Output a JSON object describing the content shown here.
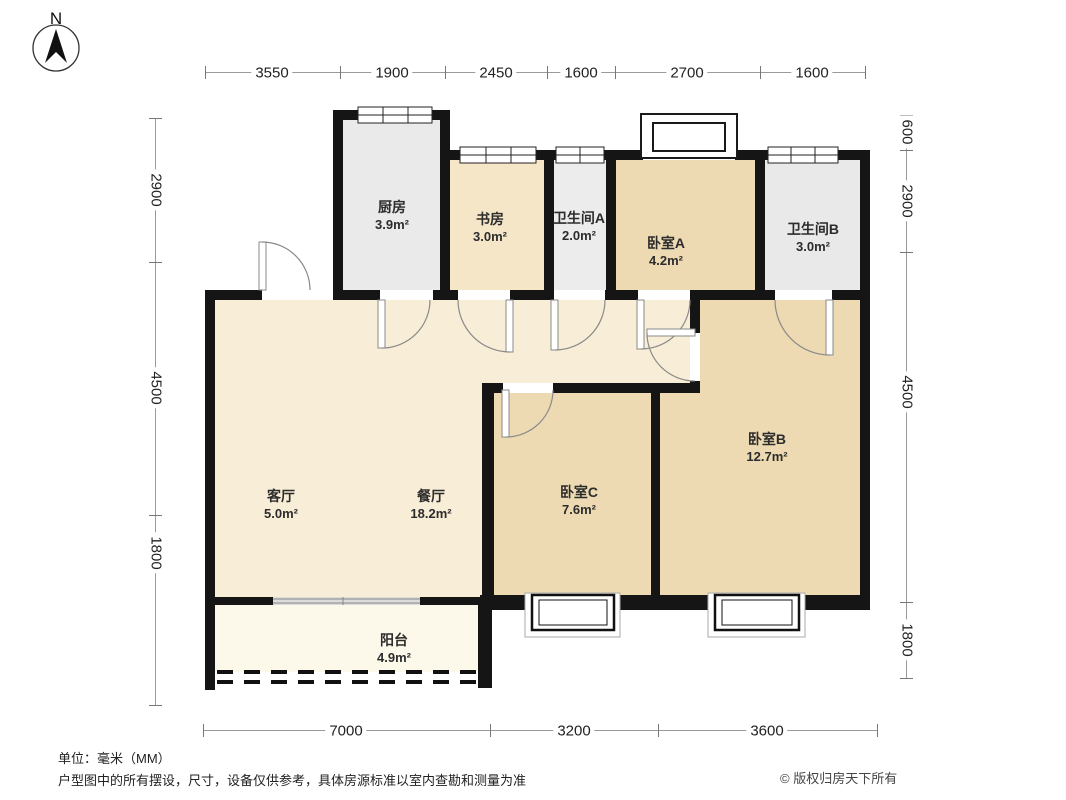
{
  "compass": {
    "label": "N"
  },
  "dims": {
    "top": [
      "3550",
      "1900",
      "2450",
      "1600",
      "2700",
      "1600"
    ],
    "left": [
      "2900",
      "4500",
      "1800"
    ],
    "right": [
      "600",
      "2900",
      "4500",
      "1800"
    ],
    "bottom": [
      "7000",
      "3200",
      "3600"
    ]
  },
  "rooms": [
    {
      "id": "kitchen",
      "name": "厨房",
      "area": "3.9m²"
    },
    {
      "id": "study",
      "name": "书房",
      "area": "3.0m²"
    },
    {
      "id": "bathroom-a",
      "name": "卫生间A",
      "area": "2.0m²"
    },
    {
      "id": "bedroom-a",
      "name": "卧室A",
      "area": "4.2m²"
    },
    {
      "id": "bathroom-b",
      "name": "卫生间B",
      "area": "3.0m²"
    },
    {
      "id": "living-room",
      "name": "客厅",
      "area": "5.0m²"
    },
    {
      "id": "dining-room",
      "name": "餐厅",
      "area": "18.2m²"
    },
    {
      "id": "bedroom-c",
      "name": "卧室C",
      "area": "7.6m²"
    },
    {
      "id": "bedroom-b",
      "name": "卧室B",
      "area": "12.7m²"
    },
    {
      "id": "balcony",
      "name": "阳台",
      "area": "4.9m²"
    }
  ],
  "footer": {
    "unit_note": "单位：毫米（MM）",
    "disclaimer": "户型图中的所有摆设，尺寸，设备仅供参考，具体房源标准以室内查勘和测量为准",
    "copyright": "© 版权归房天下所有"
  },
  "colors": {
    "wall": "#151515",
    "living": "#f8edd6",
    "bedroom": "#eddab2",
    "study": "#f6e6c8",
    "wet_room": "#ebebeb",
    "balcony": "#fcf8ea",
    "dim_line": "#9a9a9a"
  }
}
